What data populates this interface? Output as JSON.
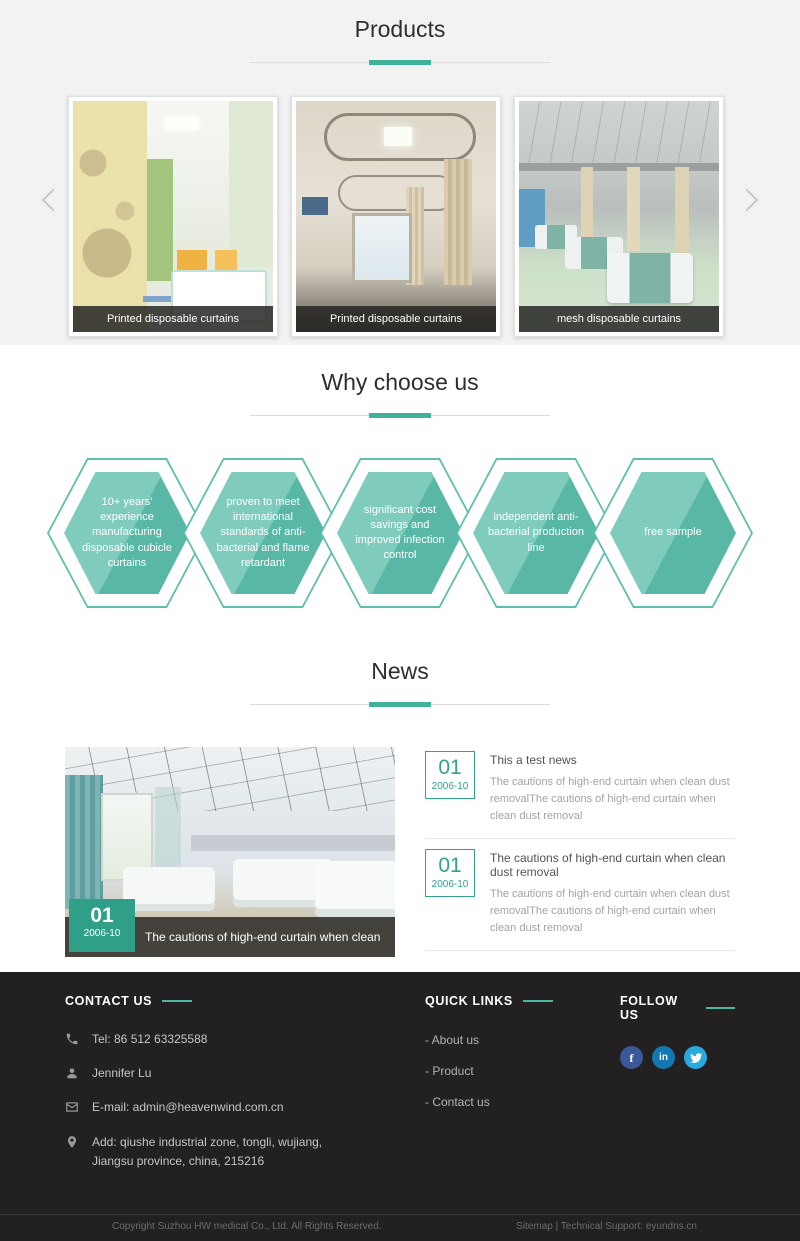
{
  "colors": {
    "accent": "#3eb39a",
    "section_bg": "#f2f2f2",
    "footer_bg": "#232021",
    "hex_light": "#7fccbc",
    "hex_dark": "#58b8a5",
    "facebook": "#3b5998",
    "linkedin": "#1178b3",
    "twitter": "#28a9e0"
  },
  "products": {
    "title": "Products",
    "items": [
      {
        "caption": "Printed disposable curtains"
      },
      {
        "caption": "Printed disposable curtains"
      },
      {
        "caption": "mesh disposable curtains"
      }
    ]
  },
  "why": {
    "title": "Why choose us",
    "hexagons": [
      "10+ years' experience manufacturing disposable cubicle curtains",
      "proven to meet international standards of anti-bacterial and flame retardant",
      "significant cost savings and improved infection control",
      "independent anti-bacterial production line",
      "free sample"
    ]
  },
  "news": {
    "title": "News",
    "featured": {
      "day": "01",
      "date": "2006-10",
      "caption": "The cautions of high-end curtain when clean dust removal"
    },
    "items": [
      {
        "day": "01",
        "date": "2006-10",
        "title": "This a test news",
        "body": "The cautions of high-end curtain when clean dust removalThe cautions of high-end curtain when clean dust removal"
      },
      {
        "day": "01",
        "date": "2006-10",
        "title": "The cautions of high-end curtain when clean dust removal",
        "body": "The cautions of high-end curtain when clean dust removalThe cautions of high-end curtain when clean dust removal"
      }
    ]
  },
  "footer": {
    "contact": {
      "heading": "CONTACT US",
      "tel": "Tel: 86 512 63325588",
      "person": "Jennifer Lu",
      "email": "E-mail: admin@heavenwind.com.cn",
      "address": "Add: qiushe industrial zone, tongli, wujiang, Jiangsu province, china, 215216"
    },
    "quick_links": {
      "heading": "QUICK LINKS",
      "links": [
        "- About us",
        "- Product",
        "- Contact us"
      ]
    },
    "follow": {
      "heading": "FOLLOW US",
      "networks": [
        "facebook",
        "linkedin",
        "twitter"
      ]
    },
    "copyright": "Copyright Suzhou HW medical Co., Ltd. All Rights Reserved.",
    "support": "Sitemap | Technical Support: eyundns.cn"
  }
}
